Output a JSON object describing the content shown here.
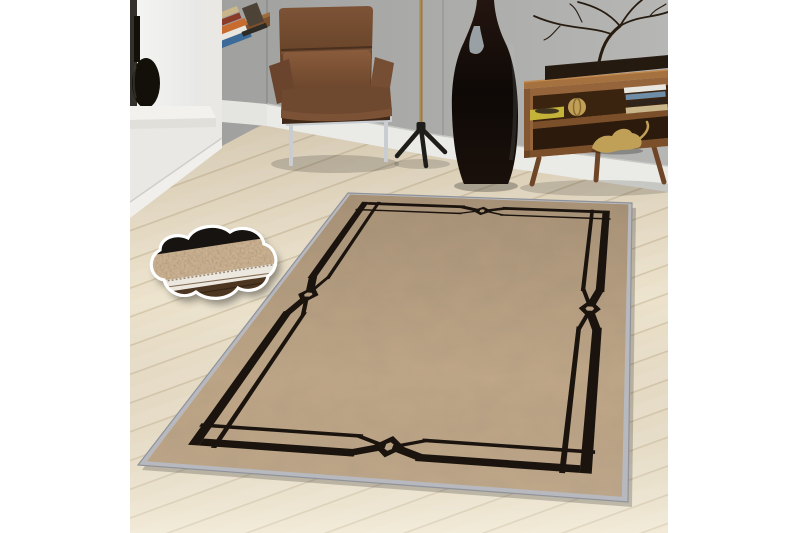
{
  "scene": {
    "objects": [
      "window-ledge-vase-icon",
      "book-stack-icon",
      "wall-desk-icon",
      "leather-armchair-icon",
      "brass-floor-lamp-icon",
      "tall-floor-vase-icon",
      "walnut-sideboard-icon",
      "branch-sculpture-icon",
      "yellow-tray-icon",
      "gold-apple-icon",
      "gold-leopard-icon",
      "shelf-books-icon",
      "bordered-area-rug-icon",
      "texture-detail-cloud-icon",
      "wood-floor-icon",
      "gray-wall-icon"
    ]
  },
  "colors": {
    "page_bg": "#ffffff",
    "wall_left": "#9c9c9a",
    "wall_right": "#b6b6b4",
    "baseboard": "#eaeae6",
    "baseboard_shadow": "#c8c8c4",
    "floor_base": "#ece2cb",
    "floor_seam": "#d6c9ae",
    "bay_white": "#e9e8e4",
    "window_light": "#f4f4f2",
    "window_frame": "#34302b",
    "ledge": "#f2f1ed",
    "ledge_lip": "#e0dfda",
    "vase_black": "#131009",
    "desk_wood": "#7c502d",
    "desk_wood_top": "#9c6c3e",
    "chair_leather": "#6f4830",
    "chair_leather_top": "#7d5336",
    "chair_leather_dark": "#58381f",
    "chair_lumbar_light": "#8a5c3c",
    "chair_lumbar_dark": "#68432a",
    "chrome": "#c9cdd2",
    "lamp_gold": "#c09b59",
    "lamp_gold_dark": "#93703a",
    "lamp_base": "#1f1d1a",
    "floor_vase_dark": "#0e0906",
    "floor_vase_brown": "#241510",
    "vase_sheen": "#b9c5ca",
    "sideboard_wood": "#96643a",
    "sideboard_wood_dark": "#6e4526",
    "sideboard_interior": "#3a230f",
    "sideboard_interior_low": "#2c1b0c",
    "plinth": "#241a10",
    "branch": "#281c10",
    "tray_yellow": "#c3b439",
    "tray_contents": "#3f3322",
    "gold_decor": "#c0a057",
    "book_white": "#e9e6df",
    "book_blue": "#6f8da6",
    "book_orange": "#c76b2f",
    "book_navy": "#3c6a99",
    "book_red": "#8a3b2a",
    "book_tan": "#c9b68a",
    "book_dark": "#4d4236",
    "rug_binding": "#b7b9bf",
    "rug_edge_line": "#8f929a",
    "rug_field": "#c1a788",
    "rug_mottle": "#6b5438",
    "rug_black": "#1b140e",
    "cloud_beige": "#c9b192",
    "cloud_black": "#171310",
    "cloud_fringe": "#ece8e0",
    "cloud_stitch": "#9a8a74",
    "cloud_wood": "#4d3621",
    "cloud_wood_dark": "#362615",
    "cloud_border": "#ffffff"
  }
}
